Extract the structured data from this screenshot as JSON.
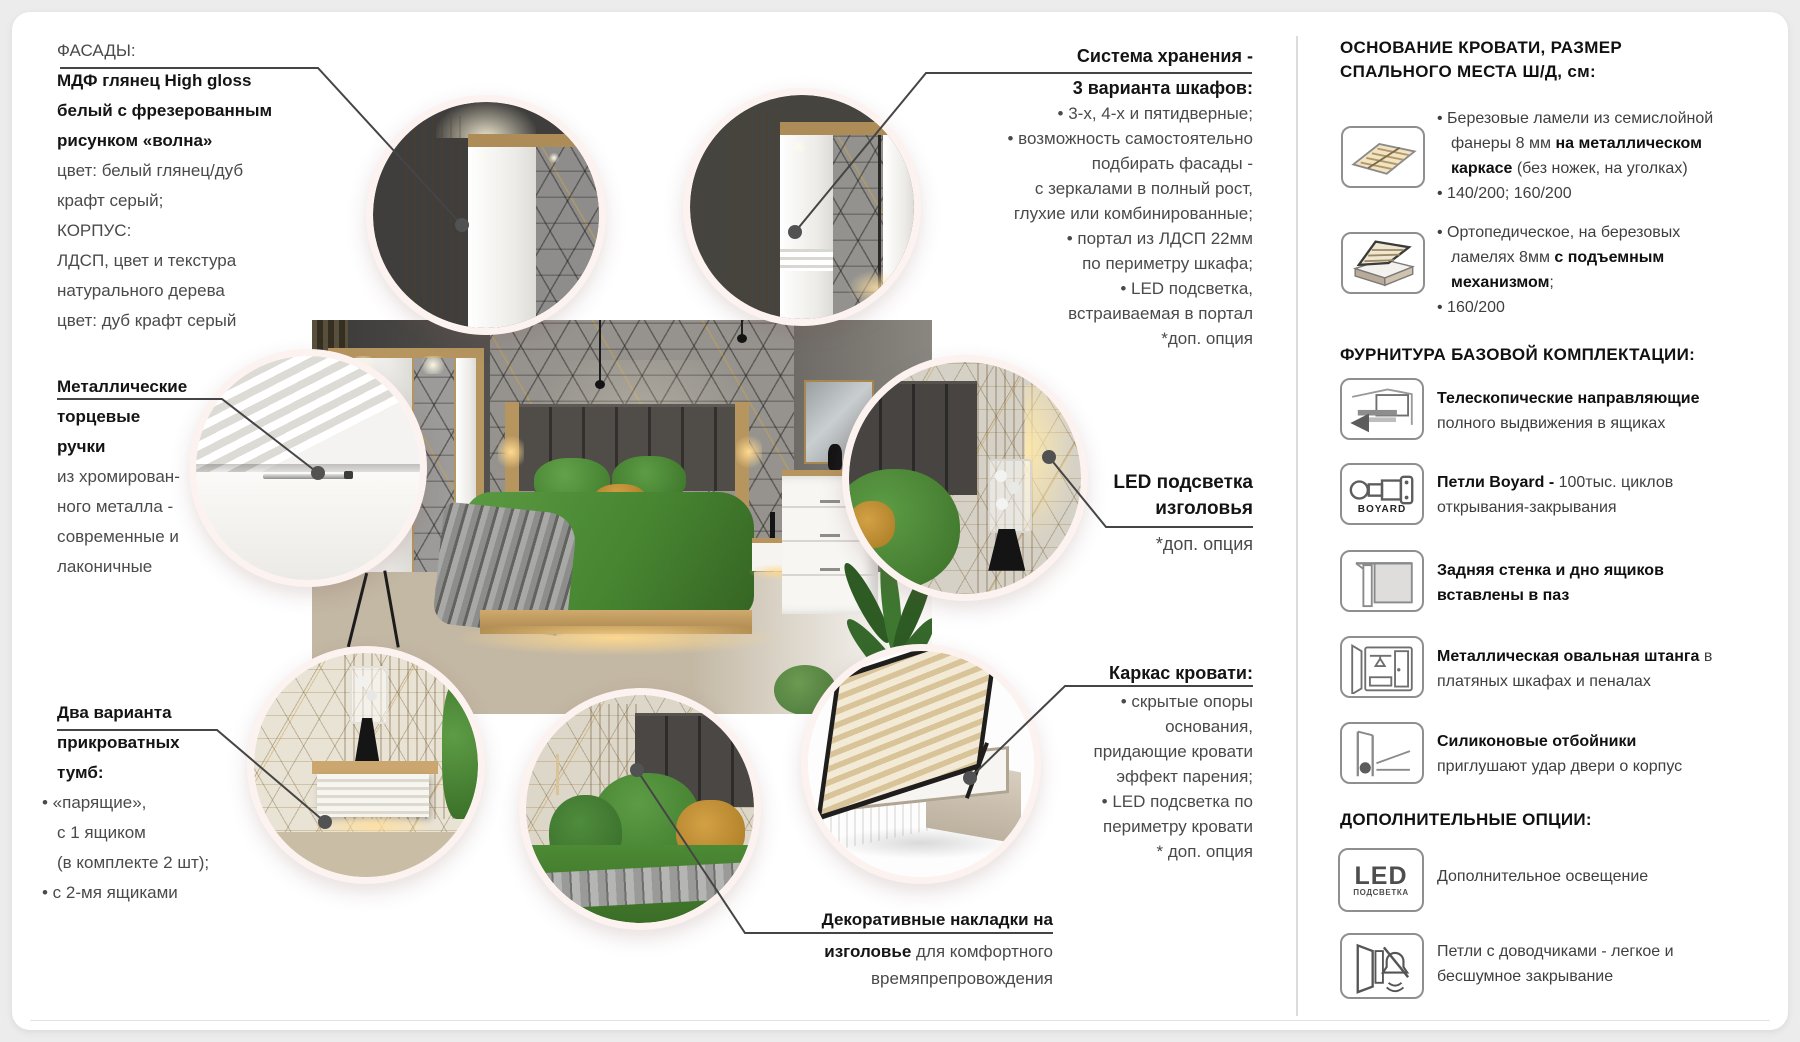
{
  "meta": {
    "title": "Мебель для спальни — инфографика комплектации",
    "accent_gold": "#c9a24d",
    "accent_green": "#4f8c3b",
    "oak_color": "#b6955f",
    "rim_color": "#fcf2f0",
    "text_regular": "#4a4a4a",
    "text_bold": "#141414"
  },
  "left_column": {
    "facades": {
      "lines": [
        [
          {
            "t": "ФАСАДЫ:"
          }
        ],
        [
          {
            "t": "МДФ глянец High gloss",
            "b": 1
          }
        ],
        [
          {
            "t": "белый с фрезерованным",
            "b": 1
          }
        ],
        [
          {
            "t": "рисунком «волна»",
            "b": 1
          }
        ],
        [
          {
            "t": "цвет: белый глянец/дуб"
          }
        ],
        [
          {
            "t": "крафт серый;"
          }
        ],
        [
          {
            "t": "КОРПУС:"
          }
        ],
        [
          {
            "t": "ЛДСП, цвет и текстура"
          }
        ],
        [
          {
            "t": "натурального дерева"
          }
        ],
        [
          {
            "t": "цвет: дуб крафт серый"
          }
        ]
      ]
    },
    "handles": {
      "lines": [
        [
          {
            "t": "Металлические",
            "b": 1
          }
        ],
        [
          {
            "t": "торцевые",
            "b": 1
          }
        ],
        [
          {
            "t": "ручки",
            "b": 1
          }
        ],
        [
          {
            "t": "из хромирован-"
          }
        ],
        [
          {
            "t": "ного металла -"
          }
        ],
        [
          {
            "t": "современные и"
          }
        ],
        [
          {
            "t": "лаконичные"
          }
        ]
      ]
    },
    "nightstands": {
      "lines": [
        [
          {
            "t": "Два варианта",
            "b": 1
          }
        ],
        [
          {
            "t": "прикроватных",
            "b": 1
          }
        ],
        [
          {
            "t": "тумб:",
            "b": 1
          }
        ],
        [
          {
            "t": "• «парящие»,",
            "bul": 1
          }
        ],
        [
          {
            "t": "с 1 ящиком"
          }
        ],
        [
          {
            "t": "(в комплекте 2 шт);"
          }
        ],
        [
          {
            "t": "• с 2-мя ящиками",
            "bul": 1
          }
        ]
      ]
    }
  },
  "callouts": {
    "storage": {
      "lines": [
        [
          {
            "t": "Система хранения -",
            "b": 1
          }
        ],
        [
          {
            "t": "3 варианта шкафов:",
            "b": 1
          }
        ],
        [
          {
            "t": "• 3-х, 4-х и пятидверные;"
          }
        ],
        [
          {
            "t": "• возможность самостоятельно"
          }
        ],
        [
          {
            "t": "подбирать фасады -"
          }
        ],
        [
          {
            "t": "с зеркалами в полный рост,"
          }
        ],
        [
          {
            "t": "глухие или комбинированные;"
          }
        ],
        [
          {
            "t": "• портал из ЛДСП 22мм"
          }
        ],
        [
          {
            "t": "по периметру шкафа;"
          }
        ],
        [
          {
            "t": "• LED подсветка,"
          }
        ],
        [
          {
            "t": "встраиваемая в портал"
          }
        ],
        [
          {
            "t": "*доп. опция"
          }
        ]
      ]
    },
    "led_headboard": {
      "lines": [
        [
          {
            "t": "LED подсветка",
            "b": 1
          }
        ],
        [
          {
            "t": "изголовья",
            "b": 1
          }
        ],
        [
          {
            "t": "*доп. опция"
          }
        ]
      ]
    },
    "bed_frame": {
      "lines": [
        [
          {
            "t": "Каркас кровати:",
            "b": 1
          }
        ],
        [
          {
            "t": "• скрытые опоры"
          }
        ],
        [
          {
            "t": "основания,"
          }
        ],
        [
          {
            "t": "придающие кровати"
          }
        ],
        [
          {
            "t": "эффект парения;"
          }
        ],
        [
          {
            "t": "• LED подсветка по"
          }
        ],
        [
          {
            "t": "периметру кровати"
          }
        ],
        [
          {
            "t": "* доп. опция"
          }
        ]
      ]
    },
    "decor_pads": {
      "lines": [
        [
          {
            "t": "Декоративные накладки на",
            "b": 1
          }
        ],
        [
          {
            "t": "изголовье",
            "b": 1
          },
          {
            "t": " для комфортного"
          }
        ],
        [
          {
            "t": "времяпрепровождения"
          }
        ]
      ]
    }
  },
  "right_column": {
    "bed_base_header": {
      "lines": [
        [
          {
            "t": "ОСНОВАНИЕ КРОВАТИ, РАЗМЕР",
            "b": 1
          }
        ],
        [
          {
            "t": "СПАЛЬНОГО МЕСТА Ш/Д, см:",
            "b": 1
          }
        ]
      ]
    },
    "bed_base_items": [
      {
        "icon": "slat-base-icon",
        "lines": [
          [
            {
              "t": "• Березовые ламели из семислойной",
              "bul": 1
            }
          ],
          [
            {
              "t": "фанеры 8 мм "
            },
            {
              "t": "на металлическом",
              "b": 1
            }
          ],
          [
            {
              "t": "каркасе",
              "b": 1
            },
            {
              "t": " (без ножек, на уголках)"
            }
          ],
          [
            {
              "t": "• 140/200; 160/200",
              "bul": 1
            }
          ]
        ]
      },
      {
        "icon": "lift-bed-icon",
        "lines": [
          [
            {
              "t": "• Ортопедическое, на березовых",
              "bul": 1
            }
          ],
          [
            {
              "t": "ламелях 8мм "
            },
            {
              "t": "с подъемным",
              "b": 1
            }
          ],
          [
            {
              "t": "механизмом",
              "b": 1
            },
            {
              "t": ";"
            }
          ],
          [
            {
              "t": "• 160/200",
              "bul": 1
            }
          ]
        ]
      }
    ],
    "hardware_header": {
      "lines": [
        [
          {
            "t": "ФУРНИТУРА БАЗОВОЙ КОМПЛЕКТАЦИИ:",
            "b": 1
          }
        ]
      ]
    },
    "hardware_items": [
      {
        "icon": "drawer-slide-icon",
        "lines": [
          [
            {
              "t": "Телескопические направляющие",
              "b": 1
            }
          ],
          [
            {
              "t": "полного выдвижения в ящиках"
            }
          ]
        ]
      },
      {
        "icon": "hinge-boyard-icon",
        "icon_label": "BOYARD",
        "lines": [
          [
            {
              "t": "Петли Boyard - ",
              "b": 1
            },
            {
              "t": "100тыс. циклов"
            }
          ],
          [
            {
              "t": "открывания-закрывания"
            }
          ]
        ]
      },
      {
        "icon": "groove-panel-icon",
        "lines": [
          [
            {
              "t": "Задняя стенка и дно ящиков",
              "b": 1
            }
          ],
          [
            {
              "t": "вставлены в паз",
              "b": 1
            }
          ]
        ]
      },
      {
        "icon": "wardrobe-rail-icon",
        "lines": [
          [
            {
              "t": "Металлическая овальная штанга",
              "b": 1
            },
            {
              "t": " в"
            }
          ],
          [
            {
              "t": "платяных шкафах и пеналах"
            }
          ]
        ]
      },
      {
        "icon": "silicone-bumper-icon",
        "lines": [
          [
            {
              "t": "Силиконовые отбойники",
              "b": 1
            }
          ],
          [
            {
              "t": "приглушают удар двери о корпус"
            }
          ]
        ]
      }
    ],
    "options_header": {
      "lines": [
        [
          {
            "t": "ДОПОЛНИТЕЛЬНЫЕ ОПЦИИ:",
            "b": 1
          }
        ]
      ]
    },
    "options_items": [
      {
        "icon": "led-light-icon",
        "icon_big": "LED",
        "icon_small": "ПОДСВЕТКА",
        "lines": [
          [
            {
              "t": "Дополнительное освещение"
            }
          ]
        ]
      },
      {
        "icon": "soft-close-hinge-icon",
        "lines": [
          [
            {
              "t": "Петли с доводчиками - легкое и"
            }
          ],
          [
            {
              "t": "бесшумное закрывание"
            }
          ]
        ]
      }
    ]
  }
}
